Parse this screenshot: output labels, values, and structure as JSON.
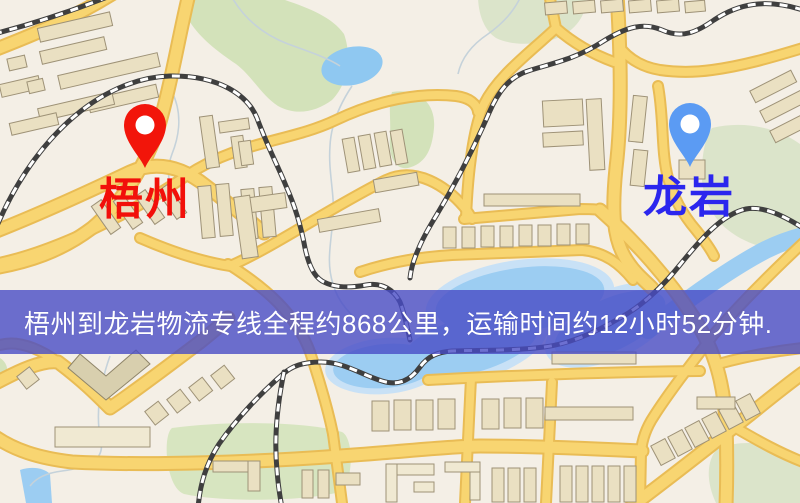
{
  "banner": {
    "text": "梧州到龙岩物流专线全程约868公里，运输时间约12小时52分钟.",
    "background": "#494cc6",
    "text_color": "#ffffff"
  },
  "markers": {
    "origin": {
      "label": "梧州",
      "pin_color": "#f2150a",
      "label_color": "#f2100a"
    },
    "destination": {
      "label": "龙岩",
      "pin_color": "#5b9bf3",
      "label_color": "#2b26ee"
    }
  },
  "map_colors": {
    "background": "#f4efe6",
    "road_fill": "#f8d571",
    "road_casing": "#e9bc55",
    "building": "#eae0c2",
    "park": "#d3e2ba",
    "water": "#9ccdf2",
    "railway_dark": "#3f3f3f",
    "railway_light": "#ffffff"
  }
}
